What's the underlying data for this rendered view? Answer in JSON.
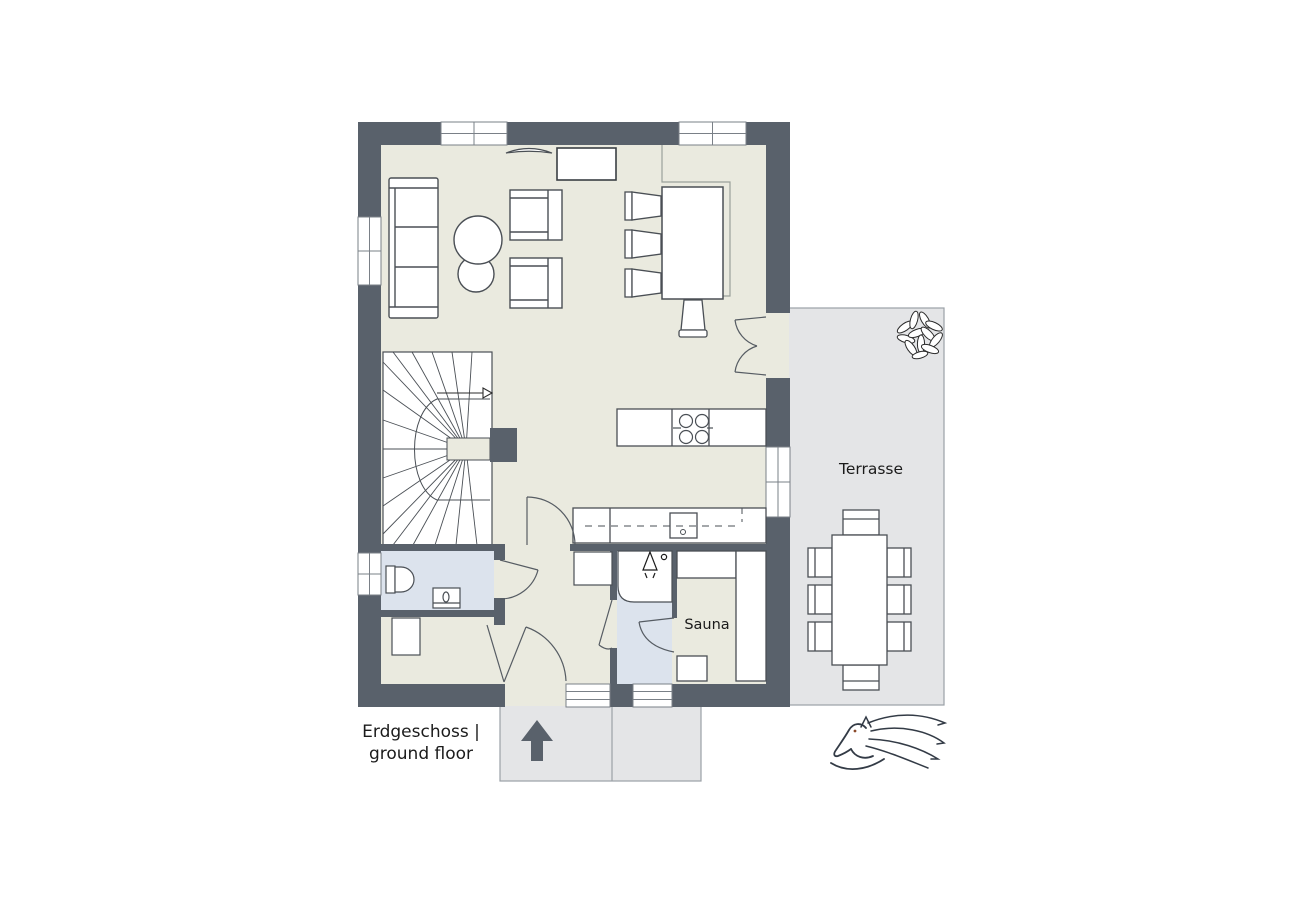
{
  "plan": {
    "floor_label_line1": "Erdgeschoss |",
    "floor_label_line2": "ground floor",
    "terrace_label": "Terrasse",
    "sauna_label": "Sauna"
  },
  "colors": {
    "wall": "#59616B",
    "floor": "#EAEADF",
    "wet_floor": "#DCE3ED",
    "outdoor_surface": "#E4E5E7",
    "furniture_outline": "#4A4F55",
    "logo": "#333B46",
    "text": "#1B1B1B"
  },
  "icons": {
    "plant": "plant-icon",
    "entrance_arrow": "entrance-arrow-icon",
    "stairs_arrow": "stairs-direction-arrow",
    "shower": "shower-head-icon",
    "horse": "horse-logo"
  }
}
